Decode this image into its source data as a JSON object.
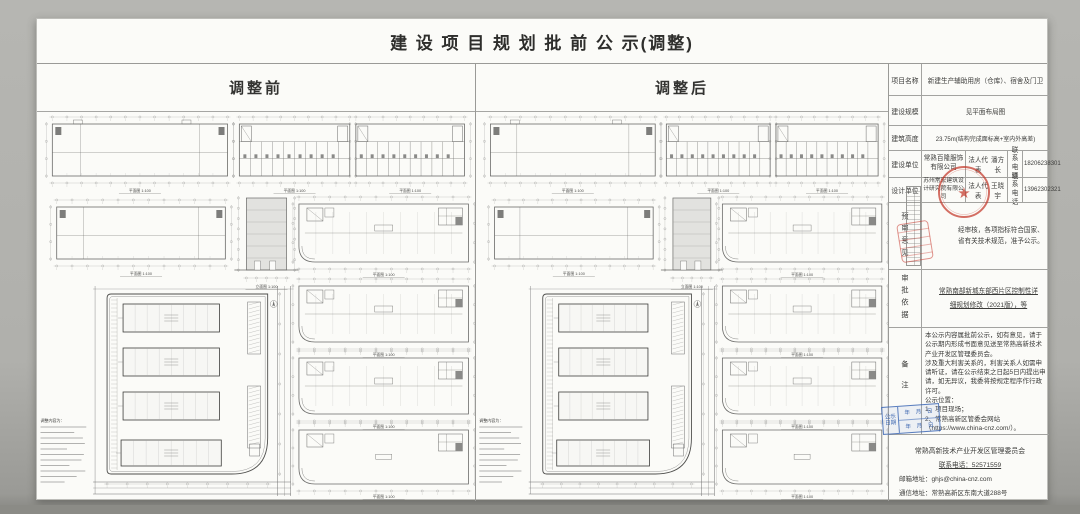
{
  "page": {
    "title": "建 设 项 目 规 划 批 前 公 示(调整)"
  },
  "panels": {
    "before": {
      "header": "调整前"
    },
    "after": {
      "header": "调整后"
    }
  },
  "drawings": {
    "plan_caption": "平面图 1:100",
    "elevation_caption": "立面图 1:100",
    "notes_heading": "调整内容为："
  },
  "table": {
    "rows": {
      "project_name": {
        "label": "项目名称",
        "value": "新建生产辅助用房（仓库）、宿舍及门卫"
      },
      "scale": {
        "label": "建设规模",
        "value": "见平面布局图"
      },
      "height": {
        "label": "建筑高度",
        "value": "23.75m(结构完成面标高+室内外高差)"
      },
      "builder": {
        "label": "建设单位",
        "company": "常熟百隆服饰有限公司",
        "legal_label": "法人代表",
        "legal": "潘方长",
        "contact_label": "联系电话",
        "phone": "18206238301"
      },
      "designer": {
        "label": "设计单位",
        "company": "苏州常宏建筑设计研究院有限公司",
        "legal_label": "法人代表",
        "legal": "王晓宇",
        "contact_label": "联系电话",
        "phone": "13962302321"
      },
      "review": {
        "label": "预审意见",
        "value": "经审核，各项指标符合国家、省有关技术规范，准予公示。"
      },
      "basis": {
        "label": "审批依据",
        "value": "常熟南部新城东部西片区控制性详细规划修改（2021版），等"
      },
      "remarks": {
        "label": "备注",
        "value": "本公示内容属批前公示，如有意见，请于公示期内形成书面意见送至常熟高新技术产业开发区管理委员会。\n涉及重大利害关系的，利害关系人如需申请听证，请在公示结束之日起5日内提出申请，如无异议，我委将按规定程序作行政许可。\n公示位置：\n1、项目现场；\n2、常熟高新区管委会网站\n（https://www.china-cnz.com/）。"
      }
    },
    "footer": {
      "org": "常熟高新技术产业开发区管理委员会",
      "phone_line": "联系电话：52571559",
      "email_line": "邮箱地址：ghjs@china-cnz.com",
      "address_line": "通信地址：常熟高新区东南大道288号"
    }
  },
  "stamps": {
    "blue_date": {
      "label": "公示日期",
      "row1": "年　月　日",
      "row2": "年　月　日"
    },
    "red_seal_star": "★"
  },
  "colors": {
    "stamp_red": "#c5382a",
    "stamp_blue": "#3462b2"
  }
}
